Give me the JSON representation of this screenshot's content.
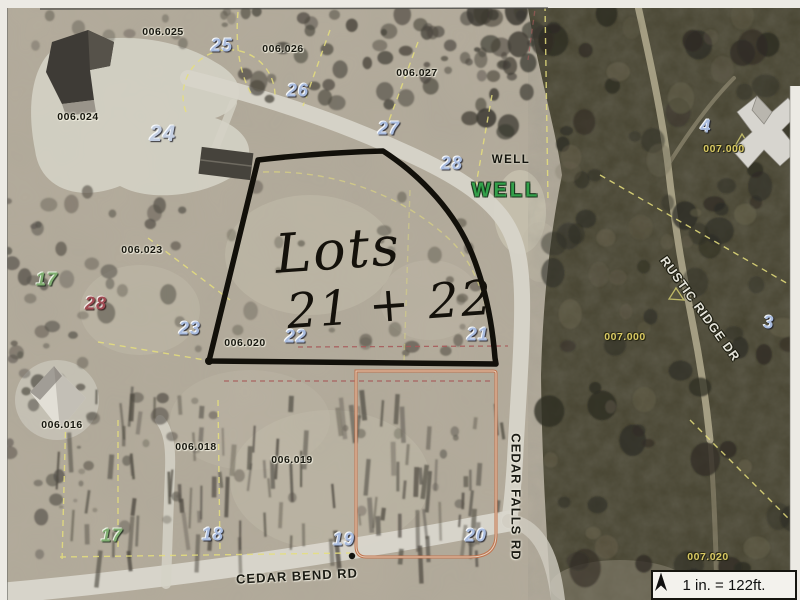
{
  "map": {
    "annotation": {
      "line1": "Lots",
      "line2": "21 + 22"
    },
    "scale": {
      "text": "1 in. = 122ft."
    },
    "lot_numbers": [
      {
        "name": "lot-number-25",
        "text": "25",
        "x": 222,
        "y": 46,
        "style": "blue"
      },
      {
        "name": "lot-number-26",
        "text": "26",
        "x": 298,
        "y": 91,
        "style": "blue"
      },
      {
        "name": "lot-number-27",
        "text": "27",
        "x": 389,
        "y": 129,
        "style": "blue"
      },
      {
        "name": "lot-number-28-north",
        "text": "28",
        "x": 452,
        "y": 164,
        "style": "blue"
      },
      {
        "name": "lot-number-24",
        "text": "24",
        "x": 163,
        "y": 134,
        "style": "pale"
      },
      {
        "name": "lot-number-4",
        "text": "4",
        "x": 706,
        "y": 127,
        "style": "blue"
      },
      {
        "name": "lot-number-3",
        "text": "3",
        "x": 769,
        "y": 323,
        "style": "blue"
      },
      {
        "name": "lot-number-23",
        "text": "23",
        "x": 190,
        "y": 329,
        "style": "blue"
      },
      {
        "name": "lot-number-22",
        "text": "22",
        "x": 296,
        "y": 337,
        "style": "blue"
      },
      {
        "name": "lot-number-21",
        "text": "21",
        "x": 478,
        "y": 335,
        "style": "blue"
      },
      {
        "name": "lot-number-17-west",
        "text": "17",
        "x": 47,
        "y": 280,
        "style": "green"
      },
      {
        "name": "lot-number-28-west",
        "text": "28",
        "x": 96,
        "y": 304,
        "style": "red"
      },
      {
        "name": "lot-number-17-south",
        "text": "17",
        "x": 112,
        "y": 536,
        "style": "green"
      },
      {
        "name": "lot-number-18",
        "text": "18",
        "x": 213,
        "y": 535,
        "style": "blue"
      },
      {
        "name": "lot-number-19",
        "text": "19",
        "x": 344,
        "y": 540,
        "style": "blue"
      },
      {
        "name": "lot-number-20",
        "text": "20",
        "x": 476,
        "y": 536,
        "style": "blue"
      }
    ],
    "parcel_ids": [
      {
        "name": "parcel-006-025",
        "text": "006.025",
        "x": 163,
        "y": 32,
        "style": "dark"
      },
      {
        "name": "parcel-006-026",
        "text": "006.026",
        "x": 283,
        "y": 49,
        "style": "dark"
      },
      {
        "name": "parcel-006-027",
        "text": "006.027",
        "x": 417,
        "y": 73,
        "style": "dark"
      },
      {
        "name": "parcel-006-024",
        "text": "006.024",
        "x": 78,
        "y": 117,
        "style": "dark"
      },
      {
        "name": "parcel-006-023",
        "text": "006.023",
        "x": 142,
        "y": 250,
        "style": "dark"
      },
      {
        "name": "parcel-006-020",
        "text": "006.020",
        "x": 245,
        "y": 343,
        "style": "dark"
      },
      {
        "name": "parcel-006-016",
        "text": "006.016",
        "x": 62,
        "y": 425,
        "style": "dark"
      },
      {
        "name": "parcel-006-018",
        "text": "006.018",
        "x": 196,
        "y": 447,
        "style": "dark"
      },
      {
        "name": "parcel-006-019",
        "text": "006.019",
        "x": 292,
        "y": 460,
        "style": "dark"
      },
      {
        "name": "parcel-007-000-north",
        "text": "007.000",
        "x": 724,
        "y": 149,
        "style": "khaki"
      },
      {
        "name": "parcel-007-000-west",
        "text": "007.000",
        "x": 625,
        "y": 337,
        "style": "khaki"
      },
      {
        "name": "parcel-007-020",
        "text": "007.020",
        "x": 708,
        "y": 557,
        "style": "khaki"
      }
    ],
    "well_labels": [
      {
        "name": "well-label-small",
        "text": "WELL",
        "x": 511,
        "y": 160,
        "style": "small"
      },
      {
        "name": "well-label-large",
        "text": "WELL",
        "x": 506,
        "y": 191,
        "style": "large"
      }
    ],
    "road_labels": [
      {
        "name": "road-label-cedar-bend",
        "text": "CEDAR BEND RD",
        "x": 297,
        "y": 576,
        "rotate": -3,
        "style": "dark"
      },
      {
        "name": "road-label-cedar-falls",
        "text": "CEDAR FALLS RD",
        "x": 516,
        "y": 497,
        "rotate": 90,
        "style": "dark"
      },
      {
        "name": "road-label-rustic-ridge",
        "text": "RUSTIC RIDGE DR",
        "x": 700,
        "y": 309,
        "rotate": 54,
        "style": "light"
      }
    ],
    "colors": {
      "highlight_outline_black": "#12100a",
      "highlight_rect_orange": "#c0734e",
      "boundary_yellow": "#e6df7d",
      "dashed_red": "#a85b5b",
      "well_green": "#33a04a",
      "lot_blue": "#a9bcdf"
    }
  }
}
